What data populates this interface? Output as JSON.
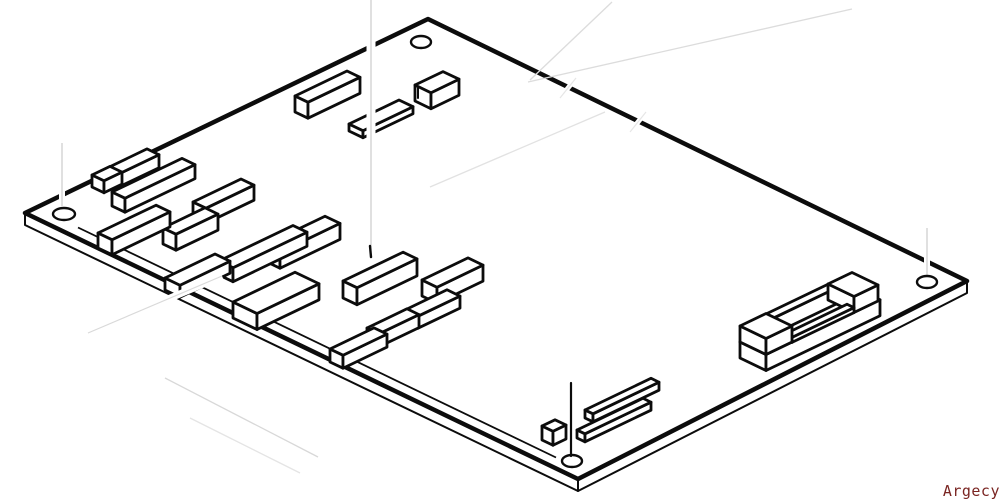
{
  "canvas": {
    "width": 1004,
    "height": 503,
    "background": "#ffffff",
    "ink": "#0c0c0c"
  },
  "watermark": {
    "label": "Argecy",
    "color": "#7a2522"
  },
  "iso": {
    "slope": 0.48
  },
  "board": {
    "corners": {
      "left": [
        25,
        213
      ],
      "top": [
        428,
        19
      ],
      "right": [
        967,
        281
      ],
      "bottom": [
        578,
        479
      ]
    },
    "thickness": 12,
    "silkscreen_line": {
      "x1": 78,
      "y1": 227.5,
      "x2": 556,
      "y2": 457.5
    },
    "holes": [
      {
        "cx": 64,
        "cy": 214,
        "rx": 11,
        "ry": 6
      },
      {
        "cx": 421,
        "cy": 42,
        "rx": 10,
        "ry": 6
      },
      {
        "cx": 927,
        "cy": 282,
        "rx": 10,
        "ry": 6
      },
      {
        "cx": 572,
        "cy": 461,
        "rx": 10,
        "ry": 6
      }
    ]
  },
  "components": [
    {
      "id": "ic-top-bar",
      "x": 295,
      "y": 112,
      "a": 52,
      "b": 13,
      "h": 16
    },
    {
      "id": "socket-top-flat",
      "x": 349,
      "y": 131,
      "a": 50,
      "b": 14,
      "h": 7
    },
    {
      "id": "cube-top",
      "x": 415,
      "y": 101,
      "a": 28,
      "b": 16,
      "h": 16
    },
    {
      "id": "ic-left-back-bar",
      "x": 101,
      "y": 184,
      "a": 46,
      "b": 12,
      "h": 13
    },
    {
      "id": "ic-left-front-box",
      "x": 92,
      "y": 187,
      "a": 18,
      "b": 12,
      "h": 12
    },
    {
      "id": "ic-left-long-bar",
      "x": 112,
      "y": 206,
      "a": 70,
      "b": 13,
      "h": 14
    },
    {
      "id": "ic-mid-upper-bar",
      "x": 193,
      "y": 217,
      "a": 48,
      "b": 13,
      "h": 15
    },
    {
      "id": "ic-center-box",
      "x": 163,
      "y": 244,
      "a": 42,
      "b": 13,
      "h": 16
    },
    {
      "id": "ic-left-lower-bar",
      "x": 98,
      "y": 248,
      "a": 58,
      "b": 14,
      "h": 15
    },
    {
      "id": "ic-mid-bar",
      "x": 265,
      "y": 261,
      "a": 60,
      "b": 15,
      "h": 16
    },
    {
      "id": "ic-mid-long-bar",
      "x": 219,
      "y": 275,
      "a": 74,
      "b": 14,
      "h": 14
    },
    {
      "id": "ic-left-bottom-box",
      "x": 165,
      "y": 290,
      "a": 50,
      "b": 15,
      "h": 12
    },
    {
      "id": "ic-right-upper-box",
      "x": 422,
      "y": 296,
      "a": 46,
      "b": 15,
      "h": 16
    },
    {
      "id": "ic-right-bar",
      "x": 343,
      "y": 298,
      "a": 60,
      "b": 14,
      "h": 17
    },
    {
      "id": "ic-right-lower-box",
      "x": 405,
      "y": 322,
      "a": 42,
      "b": 13,
      "h": 12
    },
    {
      "id": "ic-big-bar",
      "x": 233,
      "y": 318,
      "a": 62,
      "b": 24,
      "h": 16
    },
    {
      "id": "ic-right-low-small",
      "x": 367,
      "y": 341,
      "a": 40,
      "b": 12,
      "h": 13
    },
    {
      "id": "ic-bottom-small-bar",
      "x": 330,
      "y": 362,
      "a": 44,
      "b": 13,
      "h": 13
    },
    {
      "id": "connector-base",
      "x": 740,
      "y": 358,
      "a": 114,
      "b": 26,
      "h": 16
    },
    {
      "id": "connector-back-wall",
      "x": 766,
      "y": 330,
      "a": 62,
      "b": 8,
      "h": 16
    },
    {
      "id": "connector-right-block",
      "x": 828,
      "y": 300,
      "a": 24,
      "b": 26,
      "h": 16
    },
    {
      "id": "connector-front-rail",
      "x": 785,
      "y": 339,
      "a": 62,
      "b": 7,
      "h": 5
    },
    {
      "id": "connector-left-block",
      "x": 740,
      "y": 342,
      "a": 26,
      "b": 26,
      "h": 16
    },
    {
      "id": "header-rail-back",
      "x": 585,
      "y": 418,
      "a": 66,
      "b": 8,
      "h": 8
    },
    {
      "id": "small-cube-bottom",
      "x": 542,
      "y": 440,
      "a": 13,
      "b": 11,
      "h": 14
    },
    {
      "id": "header-rail-front",
      "x": 577,
      "y": 438,
      "a": 66,
      "b": 8,
      "h": 8
    }
  ],
  "leader_lines": {
    "erased_white": [
      {
        "x1": 371,
        "y1": 0,
        "x2": 371,
        "y2": 250,
        "w": 9,
        "core": "#cccccc"
      },
      {
        "x1": 62,
        "y1": 143,
        "x2": 62,
        "y2": 206,
        "w": 6,
        "core": "#cccccc"
      },
      {
        "x1": 927,
        "y1": 228,
        "x2": 927,
        "y2": 275,
        "w": 6,
        "core": "#cccccc"
      },
      {
        "x1": 88,
        "y1": 333,
        "x2": 222,
        "y2": 276,
        "w": 7,
        "core": "#d9d9d9"
      },
      {
        "x1": 576,
        "y1": 78,
        "x2": 560,
        "y2": 98,
        "w": 5,
        "core": "#e6e6e6"
      },
      {
        "x1": 646,
        "y1": 112,
        "x2": 630,
        "y2": 132,
        "w": 5,
        "core": "#e6e6e6"
      }
    ],
    "faint_gray": [
      {
        "x1": 528,
        "y1": 82,
        "x2": 852,
        "y2": 9,
        "color": "#dcdcdc"
      },
      {
        "x1": 612,
        "y1": 2,
        "x2": 530,
        "y2": 80,
        "color": "#dcdcdc"
      },
      {
        "x1": 430,
        "y1": 187,
        "x2": 605,
        "y2": 112,
        "color": "#e2e2e2"
      },
      {
        "x1": 165,
        "y1": 378,
        "x2": 318,
        "y2": 457,
        "color": "#d8d8d8"
      },
      {
        "x1": 190,
        "y1": 418,
        "x2": 300,
        "y2": 473,
        "color": "#e4e4e4"
      }
    ],
    "black": [
      {
        "x1": 571,
        "y1": 383,
        "x2": 571,
        "y2": 456,
        "w": 2.2
      }
    ],
    "ticks": [
      {
        "x1": 418,
        "y1": 88,
        "x2": 418,
        "y2": 98,
        "w": 2
      },
      {
        "x1": 370,
        "y1": 246,
        "x2": 371,
        "y2": 257,
        "w": 2.4
      }
    ]
  }
}
